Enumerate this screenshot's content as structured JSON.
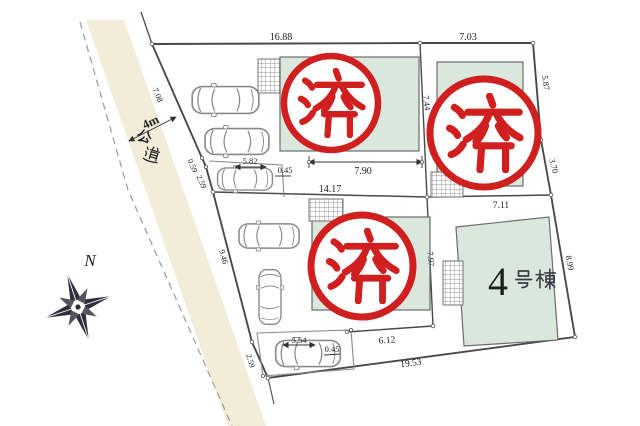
{
  "colors": {
    "stamp_red": "#cf1f1f",
    "building_fill": "#d9e7dd",
    "road_strip": "#f2ecd9"
  },
  "road": {
    "width_label": "4m",
    "name": "公道"
  },
  "compass": {
    "north": "N"
  },
  "stamp": {
    "text": "済"
  },
  "building4": {
    "number": "4",
    "suffix": "号棟"
  },
  "dimensions": {
    "top_lot1": "16.88",
    "top_lot2": "7.03",
    "road_front_upper": "7.08",
    "road_front_a": "0.59",
    "road_front_b": "2.59",
    "road_front_mid": "9.46",
    "road_front_lower": "2.59",
    "lot1_carport_w": "5.82",
    "lot1_carport_off": "0.45",
    "lot1_span": "7.90",
    "lot3_frontage": "14.17",
    "lot2_left": "7.44",
    "right_edge_upper": "5.87",
    "right_edge_mid": "3.70",
    "lot4_top": "7.11",
    "right_edge_lower": "8.99",
    "lot3_lot4_divider": "7.97",
    "lot3_bottom": "6.12",
    "bottom_edge": "19.53",
    "lot3_carport_w": "5.54",
    "lot3_carport_off": "0.45"
  }
}
